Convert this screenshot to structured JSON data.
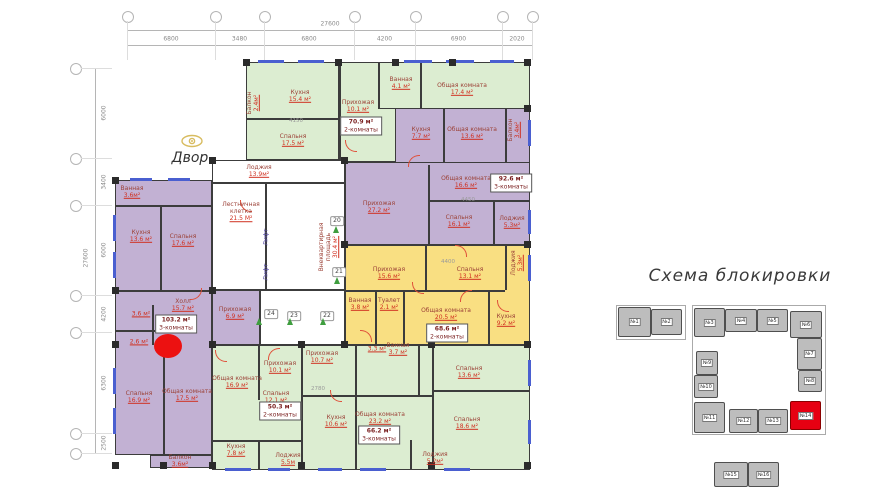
{
  "scheme": {
    "title": "Схема блокировки",
    "block_color": "#bdbdbd",
    "highlight_color": "#e60012",
    "outlines": [
      [
        616,
        305,
        70,
        35
      ],
      [
        692,
        305,
        134,
        130
      ]
    ],
    "blocks": [
      [
        618,
        307,
        33,
        30,
        "№1",
        0
      ],
      [
        651,
        309,
        31,
        26,
        "№2",
        0
      ],
      [
        694,
        308,
        31,
        29,
        "№3",
        0
      ],
      [
        725,
        309,
        32,
        23,
        "№4",
        0
      ],
      [
        757,
        309,
        31,
        23,
        "№5",
        0
      ],
      [
        790,
        311,
        32,
        27,
        "№6",
        0
      ],
      [
        797,
        338,
        25,
        32,
        "№7",
        0
      ],
      [
        798,
        370,
        24,
        22,
        "№8",
        0
      ],
      [
        696,
        351,
        22,
        24,
        "№9",
        0
      ],
      [
        694,
        375,
        24,
        23,
        "№10",
        0
      ],
      [
        694,
        402,
        31,
        31,
        "№11",
        0
      ],
      [
        729,
        409,
        29,
        24,
        "№12",
        0
      ],
      [
        758,
        409,
        30,
        24,
        "№13",
        0
      ],
      [
        790,
        401,
        31,
        29,
        "№14",
        1
      ],
      [
        714,
        462,
        34,
        25,
        "№15",
        0
      ],
      [
        748,
        462,
        31,
        25,
        "№16",
        0
      ]
    ]
  },
  "plan": {
    "yard_label": "Двор",
    "elevator_label": "Лифт",
    "colors": {
      "green": "#dcedd1",
      "purple": "#c2b1d3",
      "yellow": "#f9df82",
      "white": "#ffffff"
    },
    "blocks": [
      [
        246,
        62,
        94,
        98,
        "green"
      ],
      [
        340,
        62,
        60,
        100,
        "green"
      ],
      [
        378,
        62,
        152,
        47,
        "green"
      ],
      [
        395,
        108,
        135,
        57,
        "purple"
      ],
      [
        345,
        162,
        185,
        83,
        "purple"
      ],
      [
        345,
        245,
        185,
        100,
        "yellow"
      ],
      [
        115,
        180,
        97,
        275,
        "purple"
      ],
      [
        212,
        290,
        48,
        55,
        "purple"
      ],
      [
        212,
        345,
        90,
        125,
        "green"
      ],
      [
        302,
        345,
        228,
        125,
        "green"
      ],
      [
        212,
        160,
        133,
        130,
        "white"
      ],
      [
        260,
        290,
        85,
        55,
        "white"
      ],
      [
        150,
        455,
        62,
        13,
        "purple"
      ]
    ],
    "walls": [
      [
        338,
        62,
        2,
        98
      ],
      [
        246,
        118,
        92,
        2
      ],
      [
        378,
        62,
        2,
        47
      ],
      [
        420,
        62,
        2,
        47
      ],
      [
        443,
        108,
        2,
        55
      ],
      [
        505,
        108,
        2,
        55
      ],
      [
        428,
        165,
        2,
        80
      ],
      [
        428,
        200,
        102,
        2
      ],
      [
        493,
        202,
        2,
        43
      ],
      [
        425,
        245,
        2,
        45
      ],
      [
        345,
        290,
        160,
        2
      ],
      [
        375,
        290,
        2,
        55
      ],
      [
        403,
        290,
        2,
        55
      ],
      [
        488,
        290,
        2,
        55
      ],
      [
        505,
        245,
        2,
        45
      ],
      [
        115,
        205,
        97,
        2
      ],
      [
        160,
        207,
        2,
        83
      ],
      [
        115,
        290,
        97,
        2
      ],
      [
        152,
        305,
        2,
        40
      ],
      [
        115,
        330,
        40,
        2
      ],
      [
        163,
        345,
        2,
        110
      ],
      [
        258,
        345,
        2,
        55
      ],
      [
        212,
        440,
        90,
        2
      ],
      [
        258,
        440,
        2,
        30
      ],
      [
        355,
        345,
        2,
        50
      ],
      [
        418,
        345,
        2,
        50
      ],
      [
        302,
        395,
        130,
        2
      ],
      [
        355,
        397,
        2,
        73
      ],
      [
        432,
        345,
        2,
        125
      ],
      [
        432,
        390,
        98,
        2
      ],
      [
        410,
        440,
        2,
        30
      ],
      [
        265,
        182,
        2,
        108
      ],
      [
        212,
        182,
        133,
        2
      ]
    ],
    "windows": [
      [
        258,
        60,
        26,
        3
      ],
      [
        298,
        60,
        26,
        3
      ],
      [
        404,
        60,
        28,
        3
      ],
      [
        446,
        60,
        28,
        3
      ],
      [
        490,
        60,
        24,
        3
      ],
      [
        113,
        215,
        3,
        26
      ],
      [
        113,
        252,
        3,
        26
      ],
      [
        113,
        368,
        3,
        26
      ],
      [
        113,
        408,
        3,
        26
      ],
      [
        225,
        468,
        26,
        3
      ],
      [
        268,
        468,
        22,
        3
      ],
      [
        318,
        468,
        24,
        3
      ],
      [
        360,
        468,
        26,
        3
      ],
      [
        444,
        468,
        26,
        3
      ],
      [
        528,
        120,
        3,
        26
      ],
      [
        528,
        210,
        3,
        24
      ],
      [
        528,
        255,
        3,
        26
      ],
      [
        528,
        360,
        3,
        26
      ],
      [
        528,
        420,
        3,
        24
      ],
      [
        130,
        178,
        22,
        3
      ],
      [
        168,
        178,
        22,
        3
      ]
    ],
    "columns": [
      [
        243,
        59
      ],
      [
        335,
        59
      ],
      [
        392,
        59
      ],
      [
        449,
        59
      ],
      [
        524,
        59
      ],
      [
        112,
        177
      ],
      [
        112,
        287
      ],
      [
        112,
        341
      ],
      [
        112,
        462
      ],
      [
        209,
        157
      ],
      [
        209,
        287
      ],
      [
        209,
        341
      ],
      [
        209,
        462
      ],
      [
        341,
        157
      ],
      [
        341,
        241
      ],
      [
        341,
        341
      ],
      [
        524,
        105
      ],
      [
        524,
        241
      ],
      [
        524,
        341
      ],
      [
        524,
        462
      ],
      [
        298,
        341
      ],
      [
        298,
        462
      ],
      [
        428,
        341
      ],
      [
        428,
        462
      ],
      [
        160,
        462
      ]
    ],
    "rooms": [
      {
        "name": "Балкон",
        "area": "2.4м²",
        "x": 253,
        "y": 103,
        "v": 1
      },
      {
        "name": "Кухня",
        "area": "15.4 м²",
        "x": 300,
        "y": 96
      },
      {
        "name": "Спальня",
        "area": "17.5 м²",
        "x": 293,
        "y": 140
      },
      {
        "name": "Прихожая",
        "area": "10.1 м²",
        "x": 358,
        "y": 106
      },
      {
        "name": "Ванная",
        "area": "4.1 м²",
        "x": 401,
        "y": 83
      },
      {
        "name": "Общая комната",
        "area": "17.4 м²",
        "x": 462,
        "y": 89
      },
      {
        "name": "Кухня",
        "area": "7.7 м²",
        "x": 421,
        "y": 133
      },
      {
        "name": "Общая комната",
        "area": "13.6 м²",
        "x": 472,
        "y": 133
      },
      {
        "name": "Балкон",
        "area": "3.4м²",
        "x": 514,
        "y": 130,
        "v": 1
      },
      {
        "name": "Прихожая",
        "area": "27.2 м²",
        "x": 379,
        "y": 207
      },
      {
        "name": "Общая комната",
        "area": "16.6 м²",
        "x": 466,
        "y": 182
      },
      {
        "name": "Спальня",
        "area": "16.1 м²",
        "x": 459,
        "y": 221
      },
      {
        "name": "Лоджия",
        "area": "5.3м²",
        "x": 512,
        "y": 222
      },
      {
        "name": "Прихожая",
        "area": "15.6 м²",
        "x": 389,
        "y": 273
      },
      {
        "name": "Спальня",
        "area": "13.1 м²",
        "x": 470,
        "y": 273
      },
      {
        "name": "Лоджия",
        "area": "5.3м²",
        "x": 517,
        "y": 263,
        "v": 1
      },
      {
        "name": "Ванная",
        "area": "3.8 м²",
        "x": 360,
        "y": 304
      },
      {
        "name": "Туалет",
        "area": "2.1 м²",
        "x": 389,
        "y": 304
      },
      {
        "name": "Общая комната",
        "area": "20.5 м²",
        "x": 446,
        "y": 314
      },
      {
        "name": "Кухня",
        "area": "9.2 м²",
        "x": 506,
        "y": 320
      },
      {
        "name": "Ванная",
        "area": "3.6м²",
        "x": 132,
        "y": 192
      },
      {
        "name": "Кухня",
        "area": "13.6 м²",
        "x": 141,
        "y": 236
      },
      {
        "name": "Спальня",
        "area": "17.6 м²",
        "x": 183,
        "y": 240
      },
      {
        "name": "Холл",
        "area": "15.7 м²",
        "x": 183,
        "y": 305
      },
      {
        "name": "Прихожая",
        "area": "6.9 м²",
        "x": 235,
        "y": 313
      },
      {
        "name": "",
        "area": "3.6 м²",
        "x": 141,
        "y": 314
      },
      {
        "name": "",
        "area": "2.6 м²",
        "x": 139,
        "y": 342
      },
      {
        "name": "Спальня",
        "area": "16.9 м²",
        "x": 139,
        "y": 397
      },
      {
        "name": "Общая комната",
        "area": "17.5 м²",
        "x": 187,
        "y": 395
      },
      {
        "name": "Балкон",
        "area": "3.6м²",
        "x": 180,
        "y": 461
      },
      {
        "name": "Общая комната",
        "area": "16.9 м²",
        "x": 237,
        "y": 382
      },
      {
        "name": "Прихожая",
        "area": "10.1 м²",
        "x": 280,
        "y": 367
      },
      {
        "name": "Спальня",
        "area": "12.1 м²",
        "x": 276,
        "y": 397
      },
      {
        "name": "Кухня",
        "area": "7.8 м²",
        "x": 236,
        "y": 450
      },
      {
        "name": "Лоджия",
        "area": "5.5м",
        "x": 288,
        "y": 459
      },
      {
        "name": "Прихожая",
        "area": "10.7 м²",
        "x": 322,
        "y": 357
      },
      {
        "name": "",
        "area": "3.3 м²",
        "x": 377,
        "y": 349
      },
      {
        "name": "Ванная",
        "area": "3.7 м²",
        "x": 398,
        "y": 349
      },
      {
        "name": "Спальня",
        "area": "13.6 м²",
        "x": 469,
        "y": 372
      },
      {
        "name": "Кухня",
        "area": "10.6 м²",
        "x": 336,
        "y": 421
      },
      {
        "name": "Общая комната",
        "area": "23.2 м²",
        "x": 380,
        "y": 418
      },
      {
        "name": "Спальня",
        "area": "18.6 м²",
        "x": 467,
        "y": 423
      },
      {
        "name": "Лоджия",
        "area": "5.2м²",
        "x": 435,
        "y": 458
      },
      {
        "name": "Лоджия",
        "area": "13.9м²",
        "x": 259,
        "y": 171
      },
      {
        "name": "Лестничная клетка",
        "area": "21.5 М²",
        "x": 241,
        "y": 212
      },
      {
        "name": "Внеквартирная площадь",
        "area": "30.4 м²",
        "x": 329,
        "y": 247,
        "v": 1,
        "w": 76
      },
      {
        "name": "Лифт",
        "area": "",
        "x": 266,
        "y": 237,
        "v": 1,
        "c": "blue"
      },
      {
        "name": "Лифт",
        "area": "",
        "x": 266,
        "y": 272,
        "v": 1,
        "c": "blue"
      }
    ],
    "apartments": [
      {
        "area": "70.9 м²",
        "rooms": "2-комнаты",
        "x": 361,
        "y": 126
      },
      {
        "area": "92.6 м²",
        "rooms": "3-комнаты",
        "x": 511,
        "y": 183
      },
      {
        "area": "68.6 м²",
        "rooms": "2-комнаты",
        "x": 447,
        "y": 333
      },
      {
        "area": "103.2 м²",
        "rooms": "3-комнаты",
        "x": 176,
        "y": 324
      },
      {
        "area": "50.3 м²",
        "rooms": "2-комнаты",
        "x": 280,
        "y": 411
      },
      {
        "area": "66.2 м²",
        "rooms": "3-комнаты",
        "x": 379,
        "y": 435
      }
    ],
    "badges": [
      [
        "20",
        337,
        221
      ],
      [
        "21",
        339,
        272
      ],
      [
        "24",
        271,
        314
      ],
      [
        "23",
        294,
        316
      ],
      [
        "22",
        327,
        316
      ]
    ],
    "plants": [
      [
        256,
        318
      ],
      [
        287,
        318
      ],
      [
        320,
        318
      ],
      [
        333,
        226
      ],
      [
        334,
        277
      ]
    ],
    "arcs": [
      [
        345,
        140,
        0
      ],
      [
        408,
        155,
        90
      ],
      [
        455,
        245,
        180
      ],
      [
        412,
        282,
        0
      ],
      [
        190,
        288,
        270
      ],
      [
        215,
        350,
        0
      ],
      [
        268,
        348,
        90
      ],
      [
        330,
        390,
        0
      ],
      [
        460,
        290,
        90
      ],
      [
        240,
        200,
        0
      ],
      [
        360,
        330,
        180
      ],
      [
        497,
        300,
        0
      ]
    ],
    "inner_dims": [
      [
        "4150",
        296,
        121
      ],
      [
        "4450",
        468,
        200
      ],
      [
        "4400",
        448,
        262
      ],
      [
        "2780",
        318,
        389
      ]
    ],
    "marker": {
      "x": 168,
      "y": 346,
      "rx": 14,
      "ry": 12,
      "color": "#ec1111"
    }
  },
  "dims": {
    "top": {
      "total": "27600",
      "y": 30,
      "ticks": [
        127,
        215,
        264,
        354,
        415,
        502,
        532
      ],
      "labels": [
        "6800",
        "3480",
        "6800",
        "4200",
        "6900",
        "2020"
      ]
    },
    "left": {
      "total": "27600",
      "x": 95,
      "ticks": [
        68,
        158,
        205,
        295,
        332,
        433,
        453
      ],
      "labels": [
        "6000",
        "3400",
        "6000",
        "4200",
        "6300",
        "2500"
      ]
    }
  }
}
